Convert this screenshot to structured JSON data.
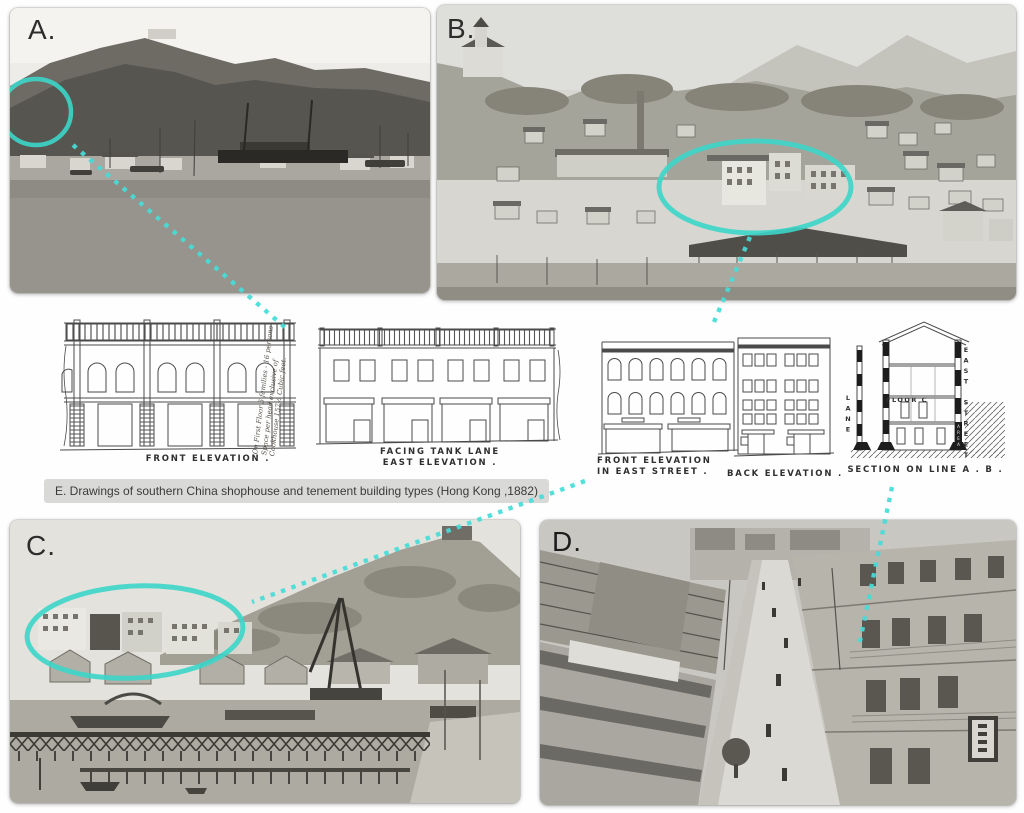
{
  "figure": {
    "annotation_color": "#3cd6c9",
    "connector_color": "#47dcd8",
    "panels": {
      "a": {
        "label": "A."
      },
      "b": {
        "label": "B."
      },
      "c": {
        "label": "C."
      },
      "d": {
        "label": "D."
      }
    },
    "caption_e": {
      "text": "E. Drawings of southern China shophouse and tenement building types (Hong Kong ,1882)"
    },
    "drawings": {
      "front_elevation": {
        "label": "FRONT ELEVATION ."
      },
      "east_elevation": {
        "label_line1": "FACING TANK LANE",
        "label_line2": "EAST ELEVATION ."
      },
      "front_elevation_east_street": {
        "label_line1": "FRONT ELEVATION",
        "label_line2": "IN EAST STREET ."
      },
      "back_elevation": {
        "label": "BACK ELEVATION ."
      },
      "section": {
        "label": "SECTION ON LINE A . B .",
        "right_street": "EAST STREET",
        "left_lane": "LANE",
        "floor": "FLOOR C",
        "area": "AREA"
      },
      "handwritten_note": {
        "line1": "On First Floor 5 families - 16 persons",
        "line2": "Space per head exclusive of",
        "line3": "Cookhouse 157½ Cubic feet."
      }
    }
  }
}
